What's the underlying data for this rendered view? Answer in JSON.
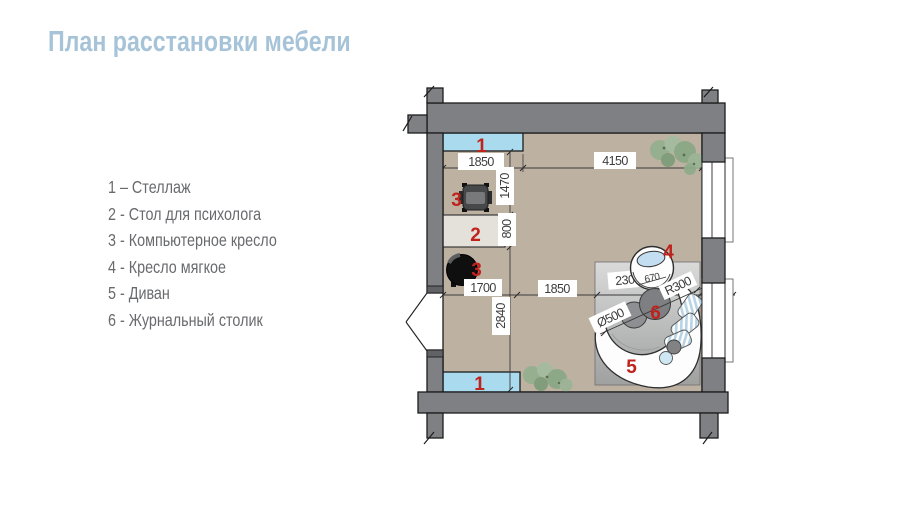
{
  "title": "План расстановки мебели",
  "legend": {
    "items": [
      {
        "text": "1 – Стеллаж"
      },
      {
        "text": "2 - Стол для психолога"
      },
      {
        "text": "3 - Компьютерное кресло"
      },
      {
        "text": "4 - Кресло мягкое"
      },
      {
        "text": "5 - Диван"
      },
      {
        "text": "6 - Журнальный столик"
      }
    ]
  },
  "plan": {
    "markers": {
      "shelf_top": "1",
      "chair_top": "3",
      "desk": "2",
      "chair_bottom": "3",
      "armchair": "4",
      "sofa": "5",
      "coffee_table": "6",
      "shelf_bottom": "1"
    },
    "dimensions": {
      "top_left": "1850",
      "top_right": "4150",
      "height_upper": "1470",
      "desk_depth": "800",
      "mid_left": "1700",
      "mid_center": "1850",
      "mid_right": "2300",
      "sill": "150",
      "height_lower": "2840",
      "armchair_seat": "670",
      "sofa_radius": "R300",
      "table_diameter": "Ø500"
    }
  },
  "colors": {
    "title_blue": "#a6c3d8",
    "legend_gray": "#696a6d",
    "marker_red": "#c0221c",
    "wall_gray": "#7e8083",
    "floor_tan": "#bdb1a2",
    "shelf_blue": "#a9daee",
    "desk_light": "#e4e1db",
    "rug_gray": "#bcbebd",
    "plant_green": "#8ba887"
  }
}
